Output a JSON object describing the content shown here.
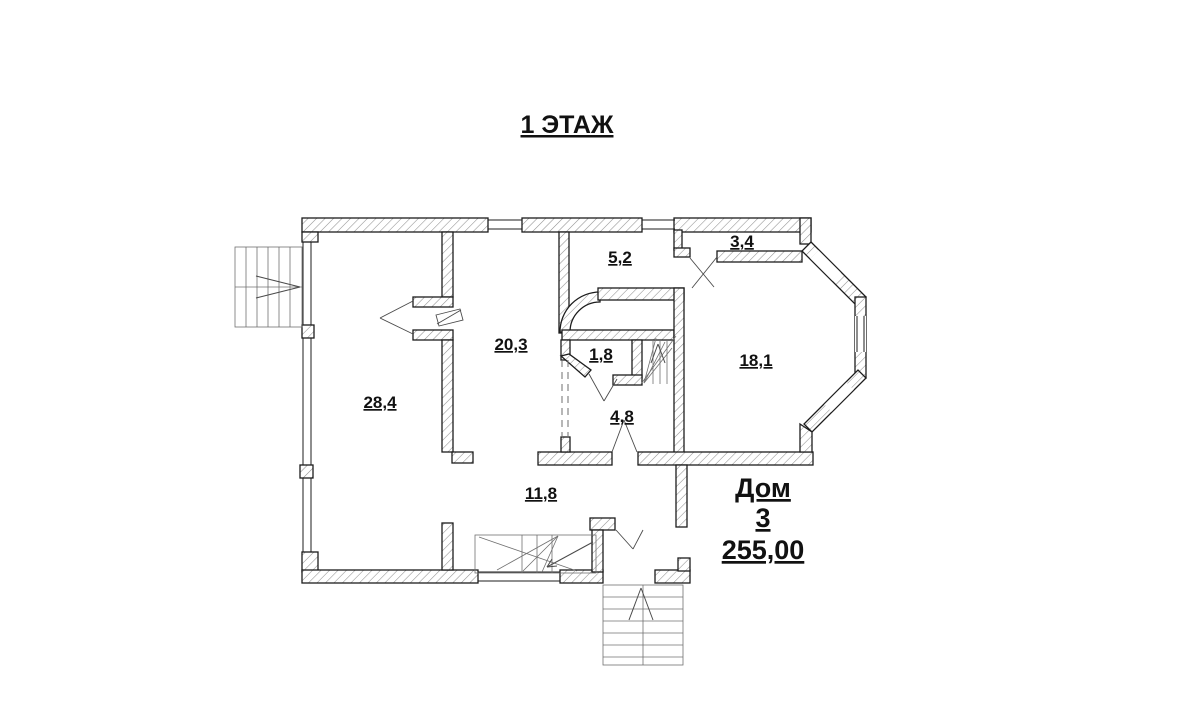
{
  "title": "1 ЭТАЖ",
  "floor_plan": {
    "rooms": [
      {
        "id": "room-28-4",
        "area": "28,4"
      },
      {
        "id": "room-20-3",
        "area": "20,3"
      },
      {
        "id": "room-5-2",
        "area": "5,2"
      },
      {
        "id": "room-3-4",
        "area": "3,4"
      },
      {
        "id": "room-1-8",
        "area": "1,8"
      },
      {
        "id": "room-4-8",
        "area": "4,8"
      },
      {
        "id": "room-18-1",
        "area": "18,1"
      },
      {
        "id": "room-11-8",
        "area": "11,8"
      }
    ],
    "house": {
      "name": "Дом",
      "number": "3",
      "total_area": "255,00"
    },
    "colors": {
      "background": "#ffffff",
      "line": "#1c1c1c",
      "hatch": "#909090",
      "thin_line": "#707070"
    }
  }
}
